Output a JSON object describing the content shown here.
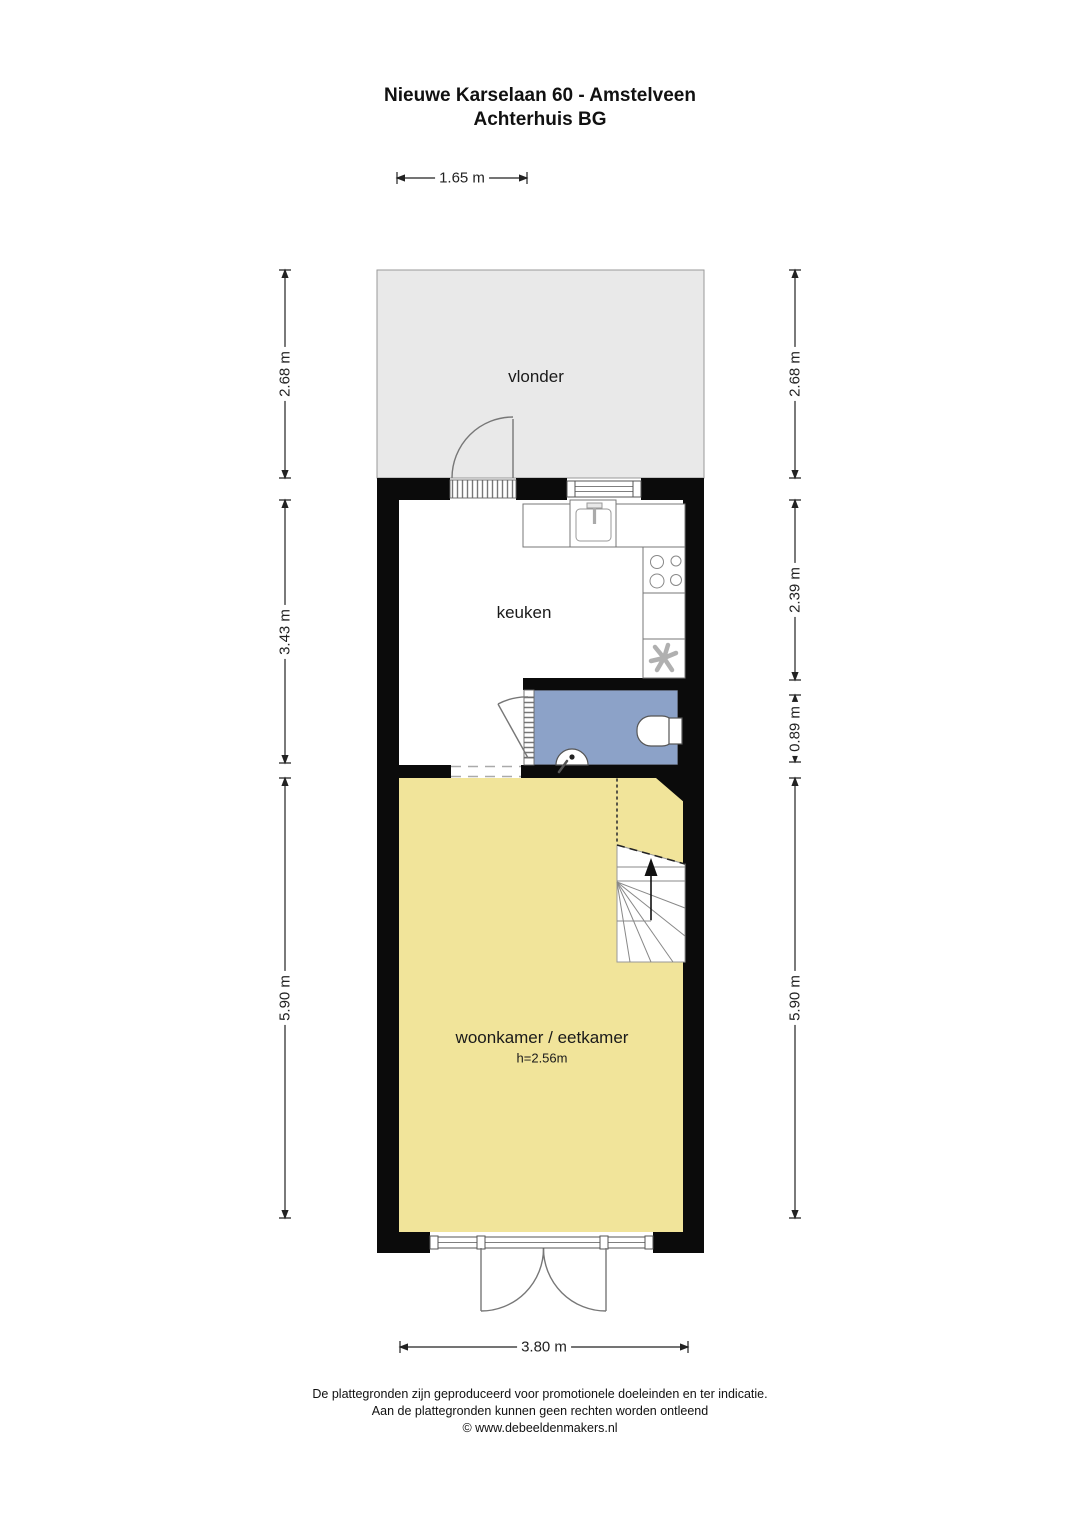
{
  "title": {
    "line1": "Nieuwe Karselaan 60 - Amstelveen",
    "line2": "Achterhuis BG"
  },
  "rooms": {
    "vlonder": {
      "label": "vlonder"
    },
    "keuken": {
      "label": "keuken"
    },
    "woonkamer": {
      "label": "woonkamer / eetkamer",
      "height_note": "h=2.56m"
    }
  },
  "dimensions": {
    "top_width": "1.65 m",
    "bottom_width": "3.80 m",
    "left": [
      "2.68 m",
      "3.43 m",
      "5.90 m"
    ],
    "right": [
      "2.68 m",
      "2.39 m",
      "0.89 m",
      "5.90 m"
    ]
  },
  "footer": {
    "line1": "De plattegronden zijn geproduceerd voor promotionele doeleinden en ter indicatie.",
    "line2": "Aan de plattegronden kunnen geen rechten worden ontleend",
    "line3": "© www.debeeldenmakers.nl"
  },
  "colors": {
    "wall": "#0b0b0b",
    "vlonder": "#e9e9e9",
    "bathroom": "#8ca2c8",
    "living": "#f1e49a",
    "fixture-line": "#777777",
    "dim-line": "#222222"
  }
}
